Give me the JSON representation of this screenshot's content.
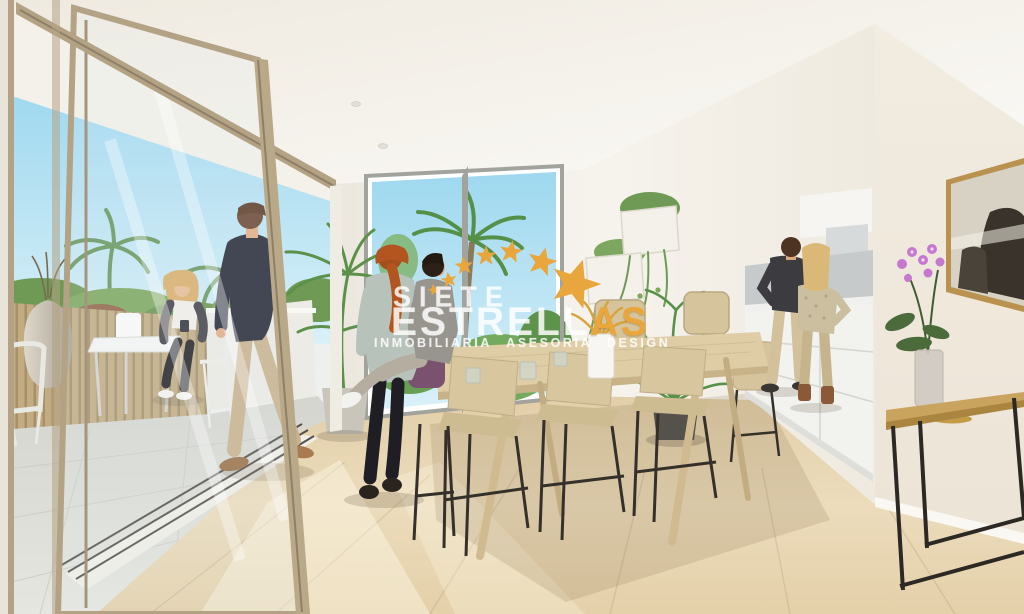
{
  "watermark": {
    "brand_top": "SIETE",
    "brand_main_white": "ESTRELL",
    "brand_main_gold": "AS",
    "tagline": "INMOBILIARIA ASESORIA DESIGN",
    "star_count": 7,
    "star_color": "#E9A63C"
  },
  "scene": {
    "description": "Bright open-plan apartment rendering: folding glass doors to a terrace with palms, dining table with wooden chairs, white kitchen with couple, orchid on console, framed seascape art.",
    "palette": {
      "wall": "#F3EFE8",
      "right_wall": "#EFE8DC",
      "ceiling": "#F7F5F0",
      "floor_wood": "#E4D2AF",
      "terrace_tile": "#DCDCD5",
      "sky": "#A8DDF0",
      "foliage": "#6FA15C",
      "door_frame": "#B3A284",
      "fence_wood": "#C3AC82",
      "table_wood": "#DFCDA6",
      "chair_wood": "#D6C49C",
      "chair_metal": "#35302A",
      "kitchen_cabinet": "#F2F2EF",
      "backsplash": "#C6CACB",
      "artwork_frame": "#B8924E",
      "artwork_rock": "#3A332B",
      "orchid": "#C678CF",
      "console_wood": "#C9A45F",
      "bag": "#7B5170",
      "accent_gold": "#E9A63C"
    }
  }
}
